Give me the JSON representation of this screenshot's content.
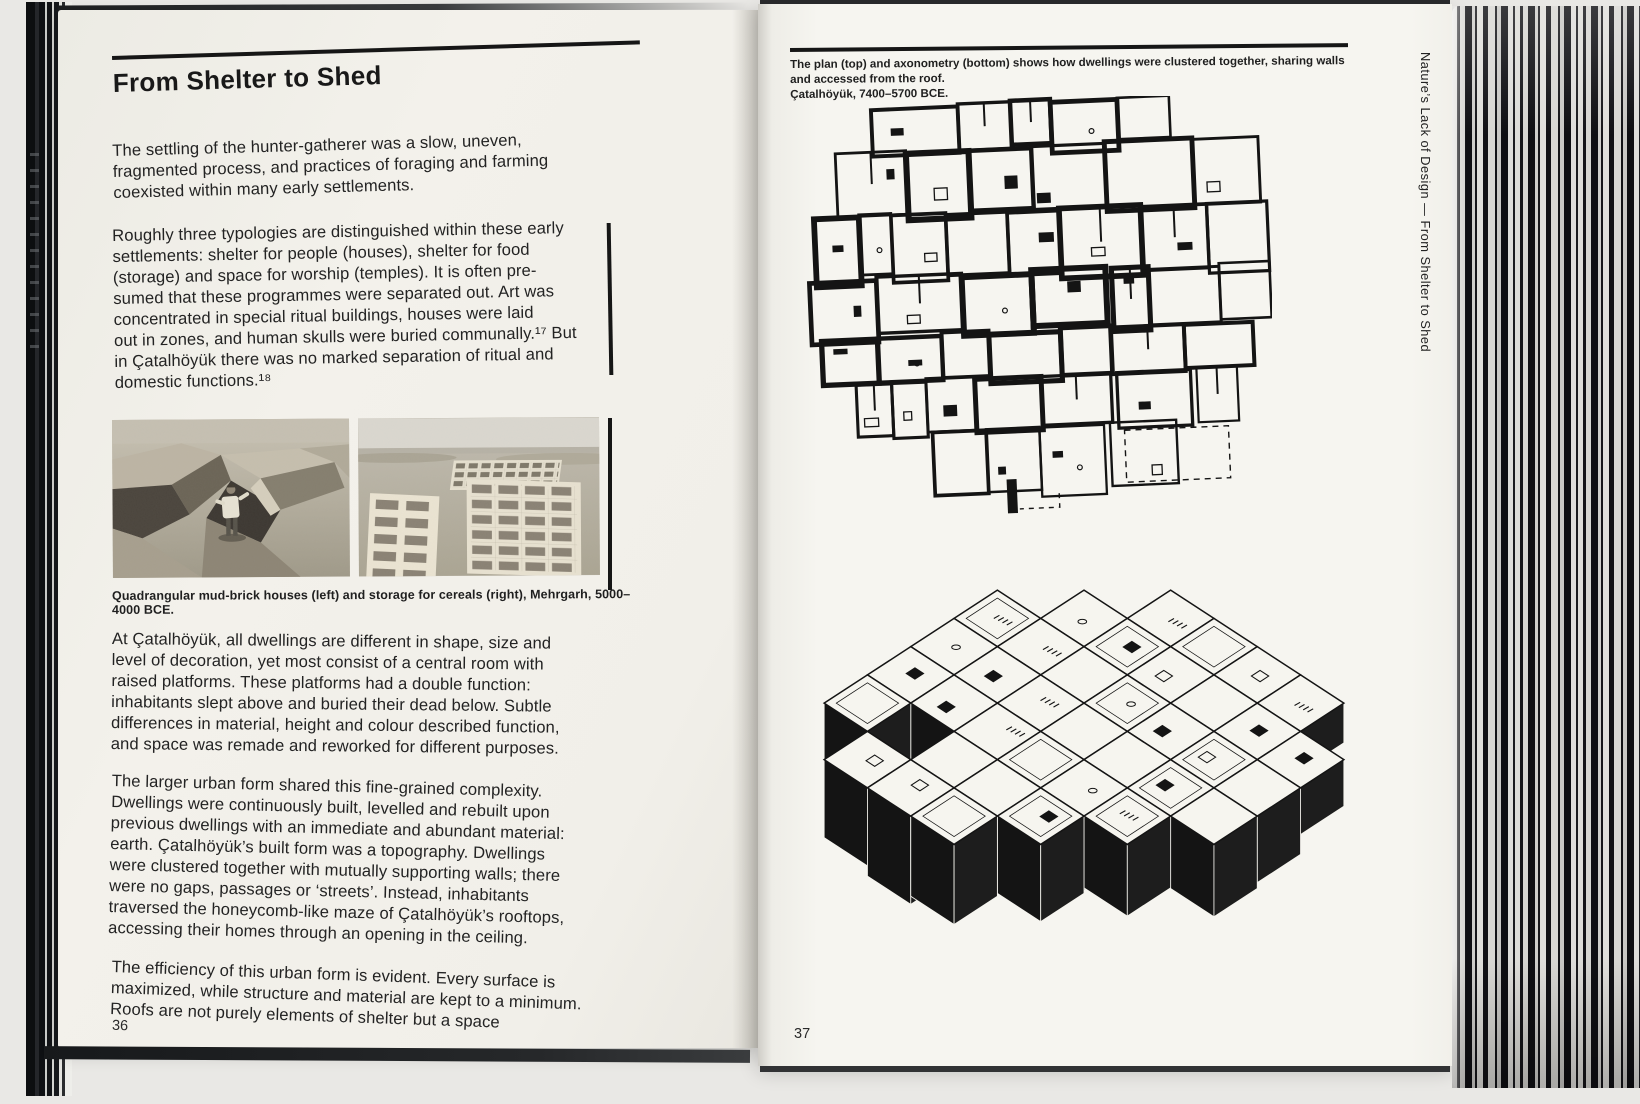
{
  "left_page": {
    "title": "From Shelter to Shed",
    "paragraphs": [
      "The settling of the hunter-gatherer was a slow, uneven,\nfragmented process, and practices of foraging and farming\ncoexisted within many early settlements.",
      "Roughly three typologies are distinguished within these early\nsettlements: shelter for people (houses), shelter for food\n(storage) and space for worship (temples). It is often pre-\nsumed that these programmes were separated out. Art was\nconcentrated in special ritual buildings, houses were laid\nout in zones, and human skulls were buried communally.¹⁷ But\nin Çatalhöyük there was no marked separation of ritual and\ndomestic functions.¹⁸",
      "At Çatalhöyük, all dwellings are different in shape, size and\nlevel of decoration, yet most consist of a central room with\nraised platforms. These platforms had a double function:\ninhabitants slept above and buried their dead below. Subtle\ndifferences in material, height and colour described function,\nand space was remade and reworked for different purposes.",
      "The larger urban form shared this fine-grained complexity.\nDwellings were continuously built, levelled and rebuilt upon\nprevious dwellings with an immediate and abundant material:\nearth. Çatalhöyük’s built form was a topography. Dwellings\nwere clustered together with mutually supporting walls; there\nwere no gaps, passages or ‘streets’. Instead, inhabitants\ntraversed the honeycomb-like maze of Çatalhöyük’s rooftops,\naccessing their homes through an opening in the ceiling.",
      "The efficiency of this urban form is evident. Every surface is\nmaximized, while structure and material are kept to a minimum.\nRoofs are not purely elements of shelter but a space"
    ],
    "photo_caption": "Quadrangular mud-brick houses (left) and storage for cereals (right), Mehrgarh, 5000–4000 BCE.",
    "page_number": "36"
  },
  "right_page": {
    "caption": "The plan (top) and axonometry (bottom) shows how dwellings were clustered together, sharing walls and accessed from the roof.\nÇatalhöyük, 7400–5700 BCE.",
    "page_number": "37",
    "sidebar_text": "Nature’s Lack of Design — From Shelter to Shed"
  },
  "colors": {
    "paper": "#f2f0ea",
    "ink": "#1c1c1c"
  }
}
